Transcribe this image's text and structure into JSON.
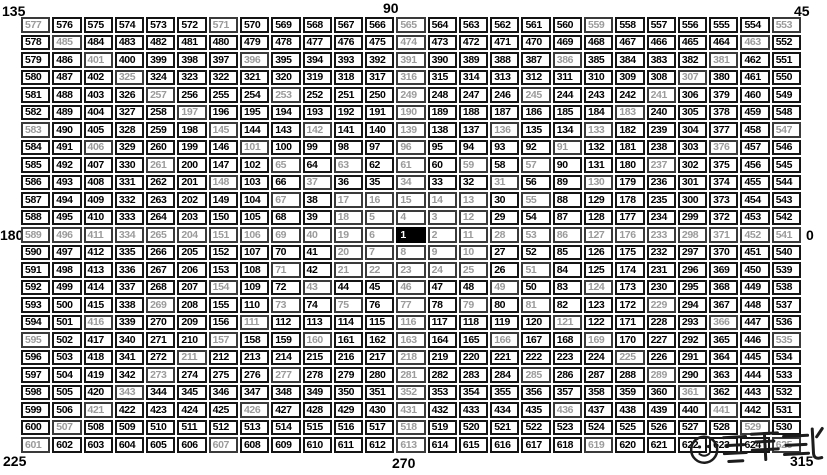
{
  "figure": "Gann Square of Nine",
  "angle_labels": {
    "top_left": "135",
    "top_center": "90",
    "top_right": "45",
    "left": "180",
    "right": "0",
    "bottom_left": "225",
    "bottom_center": "270",
    "bottom_right": "315"
  },
  "grid": {
    "size": 25,
    "center_value": 1,
    "min_value": 1,
    "max_value": 625,
    "rows": [
      [
        577,
        576,
        575,
        574,
        573,
        572,
        571,
        570,
        569,
        568,
        567,
        566,
        565,
        564,
        563,
        562,
        561,
        560,
        559,
        558,
        557,
        556,
        555,
        554,
        553
      ],
      [
        578,
        485,
        484,
        483,
        482,
        481,
        480,
        479,
        478,
        477,
        476,
        475,
        474,
        473,
        472,
        471,
        470,
        469,
        468,
        467,
        466,
        465,
        464,
        463,
        552
      ],
      [
        579,
        486,
        401,
        400,
        399,
        398,
        397,
        396,
        395,
        394,
        393,
        392,
        391,
        390,
        389,
        388,
        387,
        386,
        385,
        384,
        383,
        382,
        381,
        462,
        551
      ],
      [
        580,
        487,
        402,
        325,
        324,
        323,
        322,
        321,
        320,
        319,
        318,
        317,
        316,
        315,
        314,
        313,
        312,
        311,
        310,
        309,
        308,
        307,
        380,
        461,
        550
      ],
      [
        581,
        488,
        403,
        326,
        257,
        256,
        255,
        254,
        253,
        252,
        251,
        250,
        249,
        248,
        247,
        246,
        245,
        244,
        243,
        242,
        241,
        306,
        379,
        460,
        549
      ],
      [
        582,
        489,
        404,
        327,
        258,
        197,
        196,
        195,
        194,
        193,
        192,
        191,
        190,
        189,
        188,
        187,
        186,
        185,
        184,
        183,
        240,
        305,
        378,
        459,
        548
      ],
      [
        583,
        490,
        405,
        328,
        259,
        198,
        145,
        144,
        143,
        142,
        141,
        140,
        139,
        138,
        137,
        136,
        135,
        134,
        133,
        182,
        239,
        304,
        377,
        458,
        547
      ],
      [
        584,
        491,
        406,
        329,
        260,
        199,
        146,
        101,
        100,
        99,
        98,
        97,
        96,
        95,
        94,
        93,
        92,
        91,
        132,
        181,
        238,
        303,
        376,
        457,
        546
      ],
      [
        585,
        492,
        407,
        330,
        261,
        200,
        147,
        102,
        65,
        64,
        63,
        62,
        61,
        60,
        59,
        58,
        57,
        90,
        131,
        180,
        237,
        302,
        375,
        456,
        545
      ],
      [
        586,
        493,
        408,
        331,
        262,
        201,
        148,
        103,
        66,
        37,
        36,
        35,
        34,
        33,
        32,
        31,
        56,
        89,
        130,
        179,
        236,
        301,
        374,
        455,
        544
      ],
      [
        587,
        494,
        409,
        332,
        263,
        202,
        149,
        104,
        67,
        38,
        17,
        16,
        15,
        14,
        13,
        30,
        55,
        88,
        129,
        178,
        235,
        300,
        373,
        454,
        543
      ],
      [
        588,
        495,
        410,
        333,
        264,
        203,
        150,
        105,
        68,
        39,
        18,
        5,
        4,
        3,
        12,
        29,
        54,
        87,
        128,
        177,
        234,
        299,
        372,
        453,
        542
      ],
      [
        589,
        496,
        411,
        334,
        265,
        204,
        151,
        106,
        69,
        40,
        19,
        6,
        1,
        2,
        11,
        28,
        53,
        86,
        127,
        176,
        233,
        298,
        371,
        452,
        541
      ],
      [
        590,
        497,
        412,
        335,
        266,
        205,
        152,
        107,
        70,
        41,
        20,
        7,
        8,
        9,
        10,
        27,
        52,
        85,
        126,
        175,
        232,
        297,
        370,
        451,
        540
      ],
      [
        591,
        498,
        413,
        336,
        267,
        206,
        153,
        108,
        71,
        42,
        21,
        22,
        23,
        24,
        25,
        26,
        51,
        84,
        125,
        174,
        231,
        296,
        369,
        450,
        539
      ],
      [
        592,
        499,
        414,
        337,
        268,
        207,
        154,
        109,
        72,
        43,
        44,
        45,
        46,
        47,
        48,
        49,
        50,
        83,
        124,
        173,
        230,
        295,
        368,
        449,
        538
      ],
      [
        593,
        500,
        415,
        338,
        269,
        208,
        155,
        110,
        73,
        74,
        75,
        76,
        77,
        78,
        79,
        80,
        81,
        82,
        123,
        172,
        229,
        294,
        367,
        448,
        537
      ],
      [
        594,
        501,
        416,
        339,
        270,
        209,
        156,
        111,
        112,
        113,
        114,
        115,
        116,
        117,
        118,
        119,
        120,
        121,
        122,
        171,
        228,
        293,
        366,
        447,
        536
      ],
      [
        595,
        502,
        417,
        340,
        271,
        210,
        157,
        158,
        159,
        160,
        161,
        162,
        163,
        164,
        165,
        166,
        167,
        168,
        169,
        170,
        227,
        292,
        365,
        446,
        535
      ],
      [
        596,
        503,
        418,
        341,
        272,
        211,
        212,
        213,
        214,
        215,
        216,
        217,
        218,
        219,
        220,
        221,
        222,
        223,
        224,
        225,
        226,
        291,
        364,
        445,
        534
      ],
      [
        597,
        504,
        419,
        342,
        273,
        274,
        275,
        276,
        277,
        278,
        279,
        280,
        281,
        282,
        283,
        284,
        285,
        286,
        287,
        288,
        289,
        290,
        363,
        444,
        533
      ],
      [
        598,
        505,
        420,
        343,
        344,
        345,
        346,
        347,
        348,
        349,
        350,
        351,
        352,
        353,
        354,
        355,
        356,
        357,
        358,
        359,
        360,
        361,
        362,
        443,
        532
      ],
      [
        599,
        506,
        421,
        422,
        423,
        424,
        425,
        426,
        427,
        428,
        429,
        430,
        431,
        432,
        433,
        434,
        435,
        436,
        437,
        438,
        439,
        440,
        441,
        442,
        531
      ],
      [
        600,
        507,
        508,
        509,
        510,
        511,
        512,
        513,
        514,
        515,
        516,
        517,
        518,
        519,
        520,
        521,
        522,
        523,
        524,
        525,
        526,
        527,
        528,
        529,
        530
      ],
      [
        601,
        602,
        603,
        604,
        605,
        606,
        607,
        608,
        609,
        610,
        611,
        612,
        613,
        614,
        615,
        616,
        617,
        618,
        619,
        620,
        621,
        622,
        623,
        624,
        625
      ]
    ]
  },
  "colors": {
    "grid_line": "#141414",
    "cell_bg": "#ffffff",
    "number": "#000000",
    "angle_line_number": "#9b9b9b",
    "center_bg": "#000000",
    "center_text": "#ffffff",
    "label": "#000000",
    "watermark": "#1c1c1c"
  },
  "watermark": {
    "icon": "smiley-face",
    "style": "stylized-calligraphy",
    "text": "量化"
  }
}
